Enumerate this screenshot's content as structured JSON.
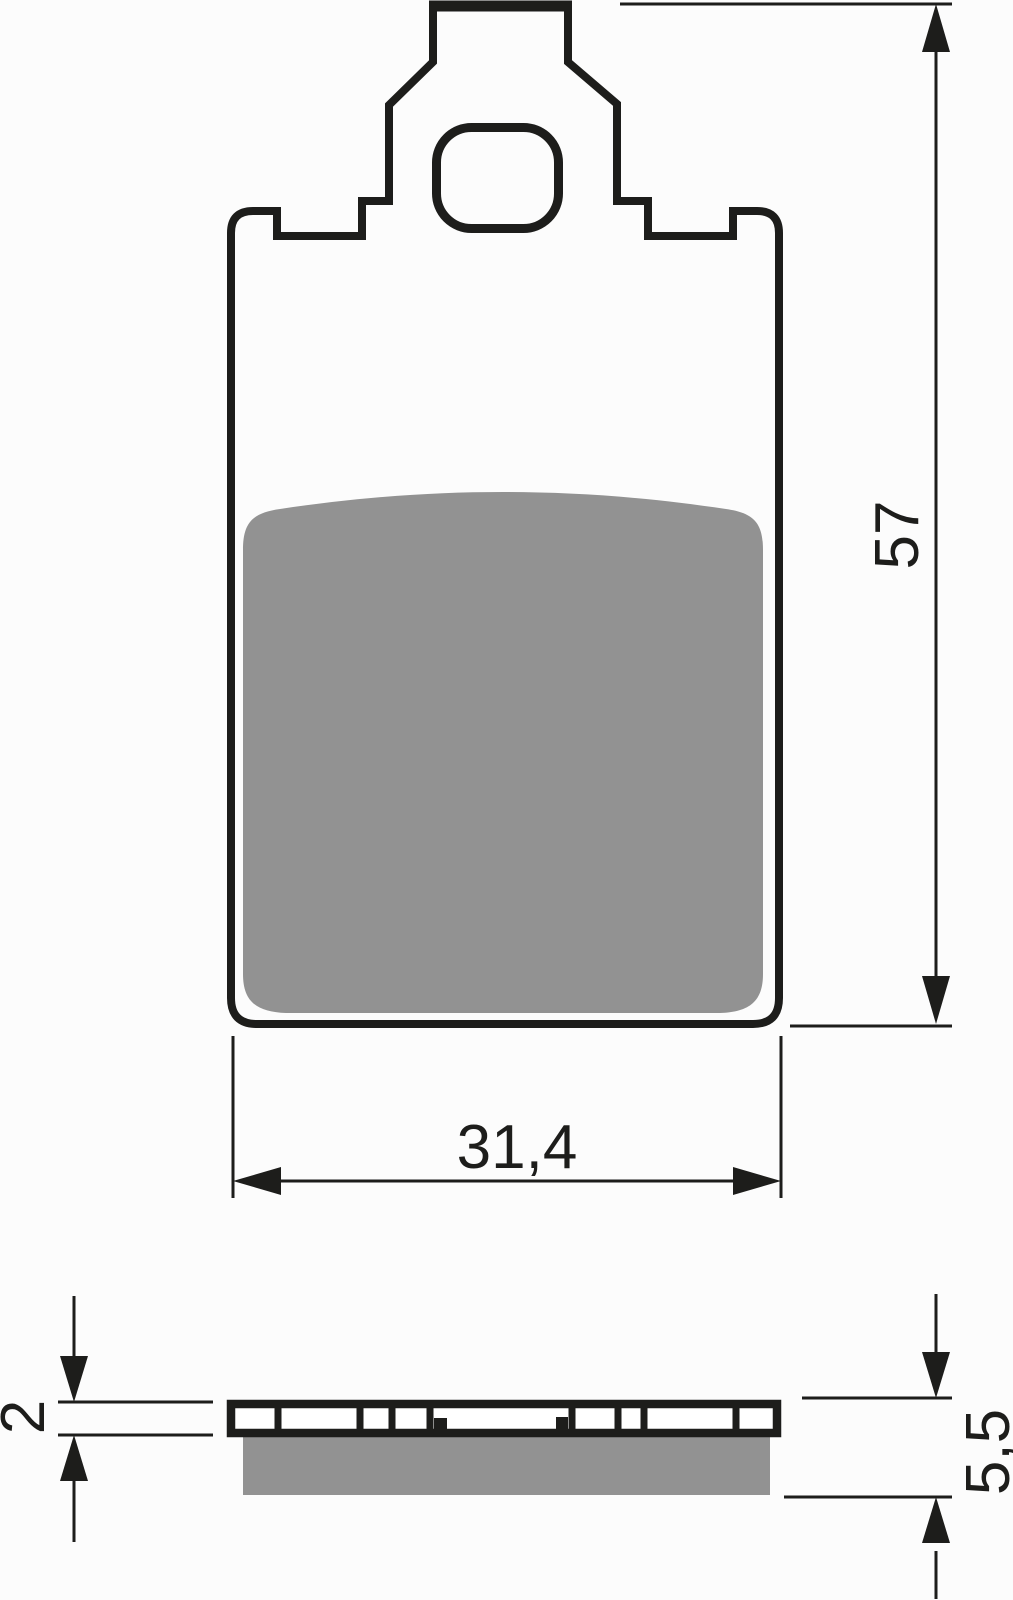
{
  "drawing_labels": {
    "overall_height_mm": "57",
    "overall_width_mm": "31,4",
    "backplate_thickness_mm": "2",
    "total_thickness_mm": "5,5"
  },
  "colors": {
    "line": "#1d1d1b",
    "friction": "#929292",
    "plate_fill": "#ffffff",
    "background": "#fcfcfc"
  }
}
